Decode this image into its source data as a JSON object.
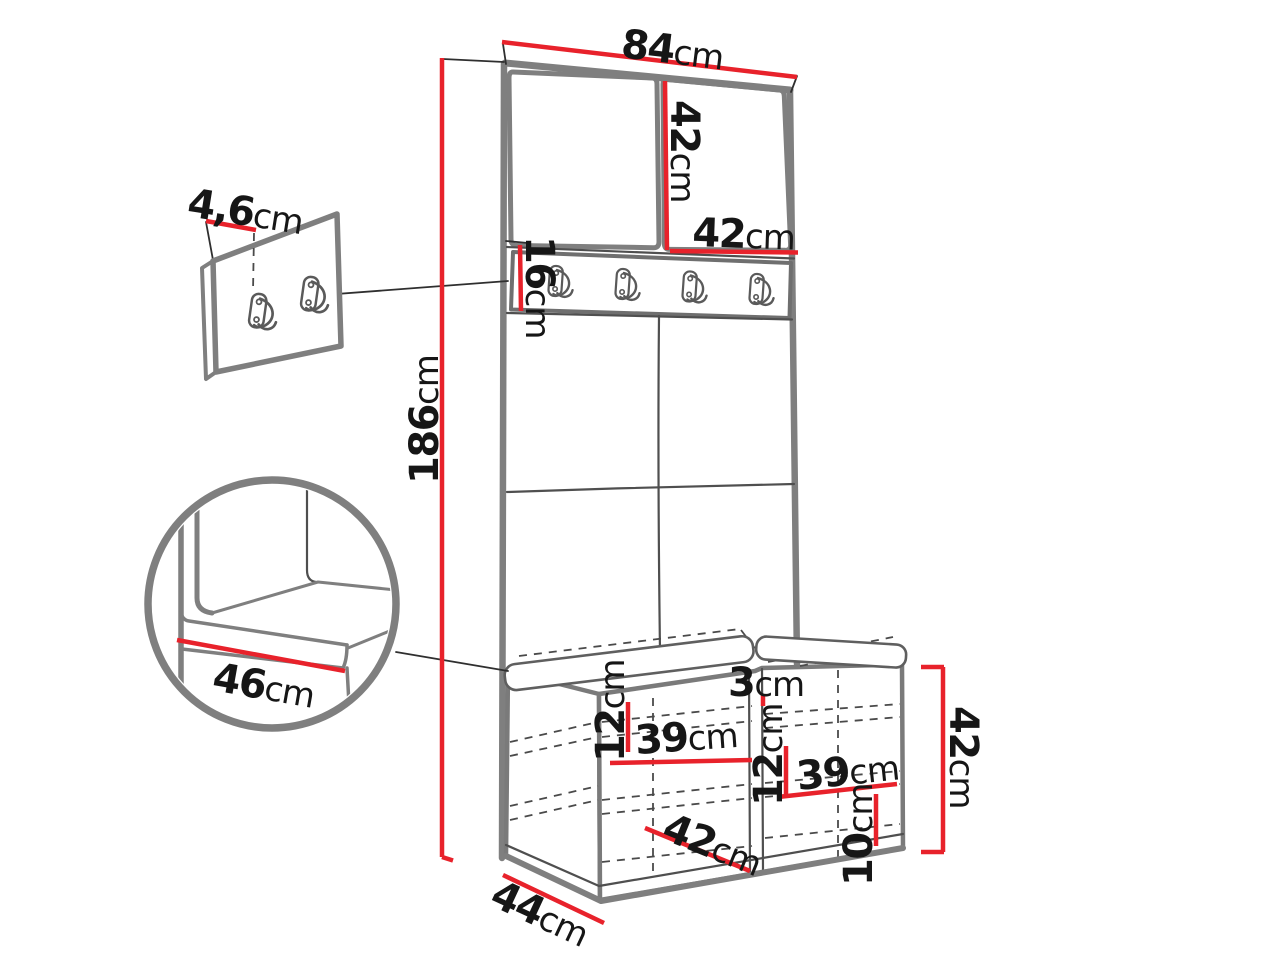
{
  "diagram_title": "hallway-unit-dimension-diagram",
  "colors": {
    "dimension_red": "#e8222b",
    "outline_gray": "#7f7f7f",
    "hidden_line_gray": "#4a4a4a",
    "text_black": "#161616",
    "background": "#ffffff"
  },
  "dimensions": {
    "top_width": {
      "value": "84",
      "unit": "cm"
    },
    "upper_door_height": {
      "value": "42",
      "unit": "cm"
    },
    "upper_door_width": {
      "value": "42",
      "unit": "cm"
    },
    "hook_rail_height": {
      "value": "16",
      "unit": "cm"
    },
    "total_height": {
      "value": "186",
      "unit": "cm"
    },
    "wall_panel_thickness": {
      "value": "4,6",
      "unit": "cm"
    },
    "seat_depth_detail": {
      "value": "46",
      "unit": "cm"
    },
    "seat_divider_gap": {
      "value": "3",
      "unit": "cm"
    },
    "left_shelf_spacing": {
      "value": "12",
      "unit": "cm"
    },
    "left_compartment_width": {
      "value": "39",
      "unit": "cm"
    },
    "right_shelf_spacing": {
      "value": "12",
      "unit": "cm"
    },
    "right_compartment_width": {
      "value": "39",
      "unit": "cm"
    },
    "bench_inner_width": {
      "value": "42",
      "unit": "cm"
    },
    "bottom_shelf_spacing": {
      "value": "10",
      "unit": "cm"
    },
    "bench_height": {
      "value": "42",
      "unit": "cm"
    },
    "bench_depth": {
      "value": "44",
      "unit": "cm"
    }
  }
}
